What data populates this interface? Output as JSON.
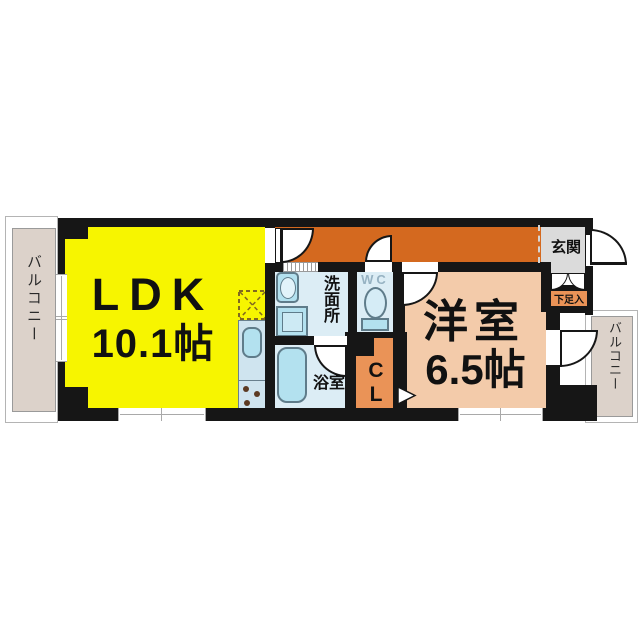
{
  "floorplan": {
    "rooms": {
      "ldk": {
        "label": "LDK",
        "size": "10.1帖"
      },
      "western_room": {
        "label": "洋室",
        "size": "6.5帖"
      },
      "washroom": {
        "label": "洗面所"
      },
      "bathroom": {
        "label": "浴室"
      },
      "toilet": {
        "label": "WC"
      },
      "closet": {
        "chars": [
          "C",
          "L"
        ]
      },
      "entrance": {
        "label": "玄関"
      },
      "shoe_cabinet": {
        "label": "下足入"
      },
      "balcony_left": {
        "label": "バルコニー"
      },
      "balcony_right": {
        "label": "バルコニー"
      }
    },
    "colors": {
      "wall": "#161616",
      "ldk_yellow": "#f7f500",
      "hallway_orange": "#d4691f",
      "western_salmon": "#f3cbaa",
      "wet_area_blue": "#dcedf5",
      "fixture_blue": "#b3e1ef",
      "fixture_border": "#5f7c8a",
      "closet_orange": "#ea9357",
      "balcony_beige": "#dcd2ca",
      "entrance_gray": "#dbdbdb",
      "wc_label_gray": "#96b2c2"
    }
  }
}
